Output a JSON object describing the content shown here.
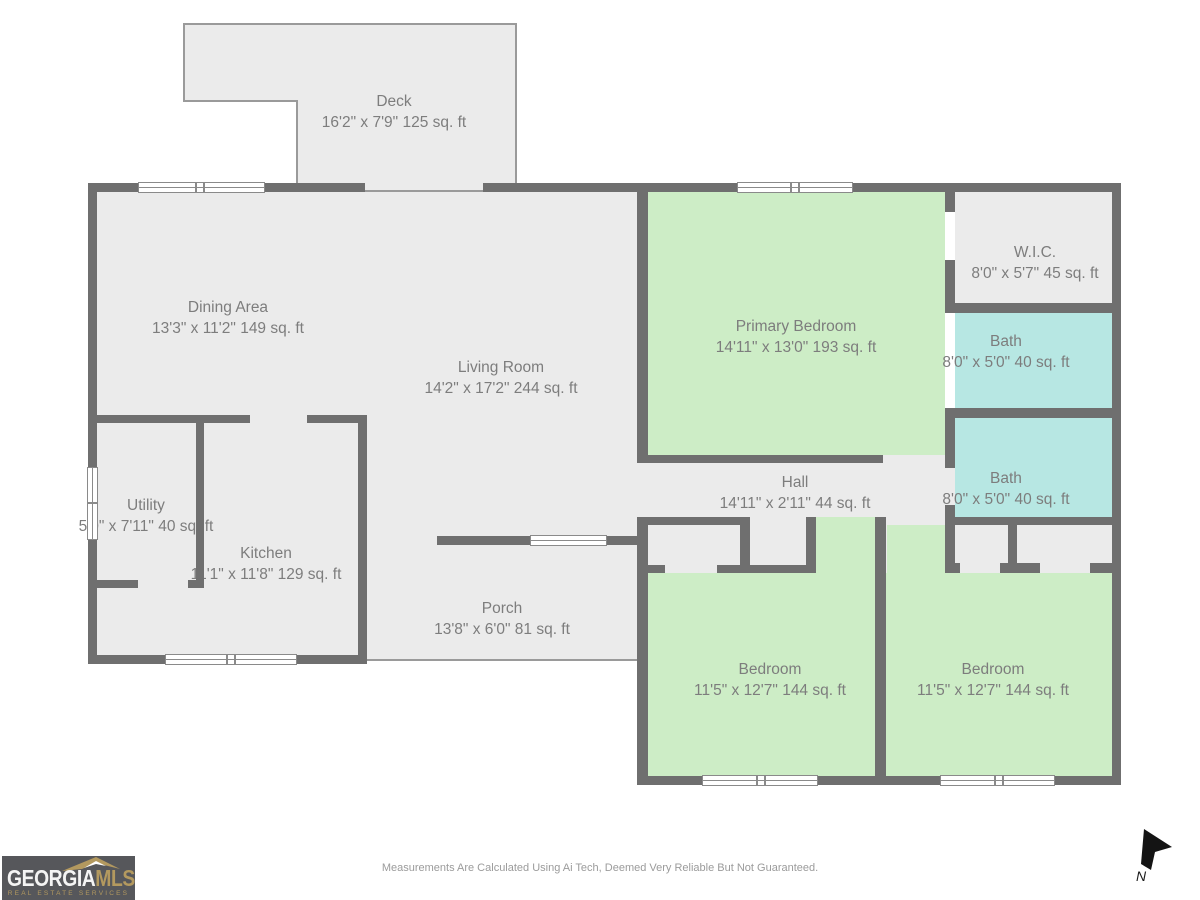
{
  "plan_title": "Residential Floor Plan",
  "rooms": [
    {
      "id": "deck",
      "name": "Deck",
      "dims": "16'2\" x 7'9\" 125 sq. ft"
    },
    {
      "id": "dining",
      "name": "Dining Area",
      "dims": "13'3\" x 11'2\" 149 sq. ft"
    },
    {
      "id": "living",
      "name": "Living Room",
      "dims": "14'2\" x 17'2\" 244 sq. ft"
    },
    {
      "id": "primary",
      "name": "Primary Bedroom",
      "dims": "14'11\" x 13'0\" 193 sq. ft"
    },
    {
      "id": "wic",
      "name": "W.I.C.",
      "dims": "8'0\" x 5'7\" 45 sq. ft"
    },
    {
      "id": "bath-upper",
      "name": "Bath",
      "dims": "8'0\" x 5'0\" 40 sq. ft"
    },
    {
      "id": "bath-lower",
      "name": "Bath",
      "dims": "8'0\" x 5'0\" 40 sq. ft"
    },
    {
      "id": "hall",
      "name": "Hall",
      "dims": "14'11\" x 2'11\" 44 sq. ft"
    },
    {
      "id": "utility",
      "name": "Utility",
      "dims": "5'0\" x 7'11\" 40 sq. ft"
    },
    {
      "id": "kitchen",
      "name": "Kitchen",
      "dims": "11'1\" x 11'8\" 129 sq. ft"
    },
    {
      "id": "porch",
      "name": "Porch",
      "dims": "13'8\" x 6'0\" 81 sq. ft"
    },
    {
      "id": "bedroom-left",
      "name": "Bedroom",
      "dims": "11'5\" x 12'7\" 144 sq. ft"
    },
    {
      "id": "bedroom-right",
      "name": "Bedroom",
      "dims": "11'5\" x 12'7\" 144 sq. ft"
    }
  ],
  "footer": {
    "disclaimer": "Measurements Are Calculated Using Ai Tech, Deemed Very Reliable But Not Guaranteed.",
    "north_label": "N",
    "logo": {
      "word1": "GEORGIA",
      "word2": "MLS",
      "subtitle": "REAL ESTATE SERVICES"
    }
  },
  "colors": {
    "wall": "#6f6f6f",
    "floor": "#ebebeb",
    "bedroom-green": "#cdedc6",
    "bath-cyan": "#b7e7e3",
    "edge": "#9a9a9a",
    "label-text": "#7d7d7d",
    "logo-bg": "#56575b",
    "logo-gold": "#b3995f",
    "muted-text": "#9b9b9b"
  }
}
